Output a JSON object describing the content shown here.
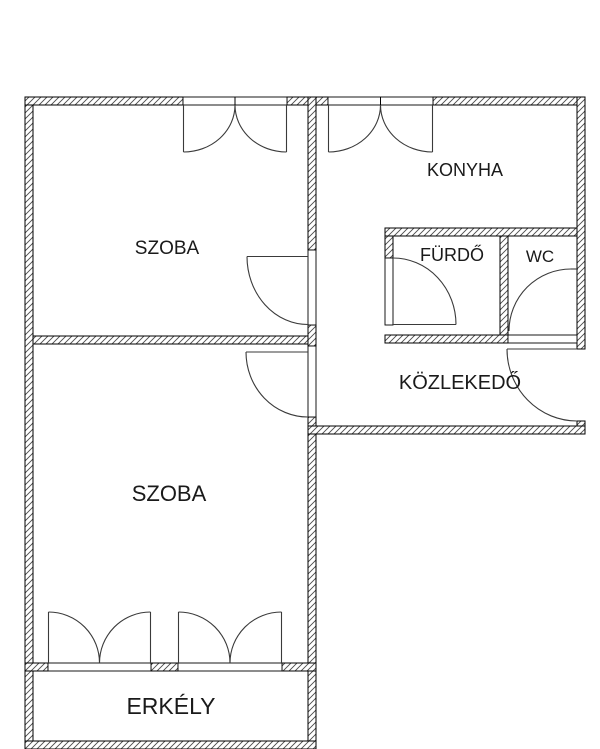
{
  "document": {
    "type": "apartment-floor-plan",
    "language": "Hungarian"
  },
  "colors": {
    "background": "#ffffff",
    "wall_line": "#000000",
    "hatch_line": "#4a4a4a",
    "door_line": "#3a3a3a",
    "label_text": "#1a1a1a"
  },
  "rooms": [
    {
      "id": "szoba-1",
      "label": "SZOBA"
    },
    {
      "id": "konyha",
      "label": "KONYHA"
    },
    {
      "id": "furdo",
      "label": "FÜRDŐ"
    },
    {
      "id": "wc",
      "label": "WC"
    },
    {
      "id": "kozlekedo",
      "label": "KÖZLEKEDŐ"
    },
    {
      "id": "szoba-2",
      "label": "SZOBA"
    },
    {
      "id": "erkely",
      "label": "ERKÉLY"
    }
  ]
}
